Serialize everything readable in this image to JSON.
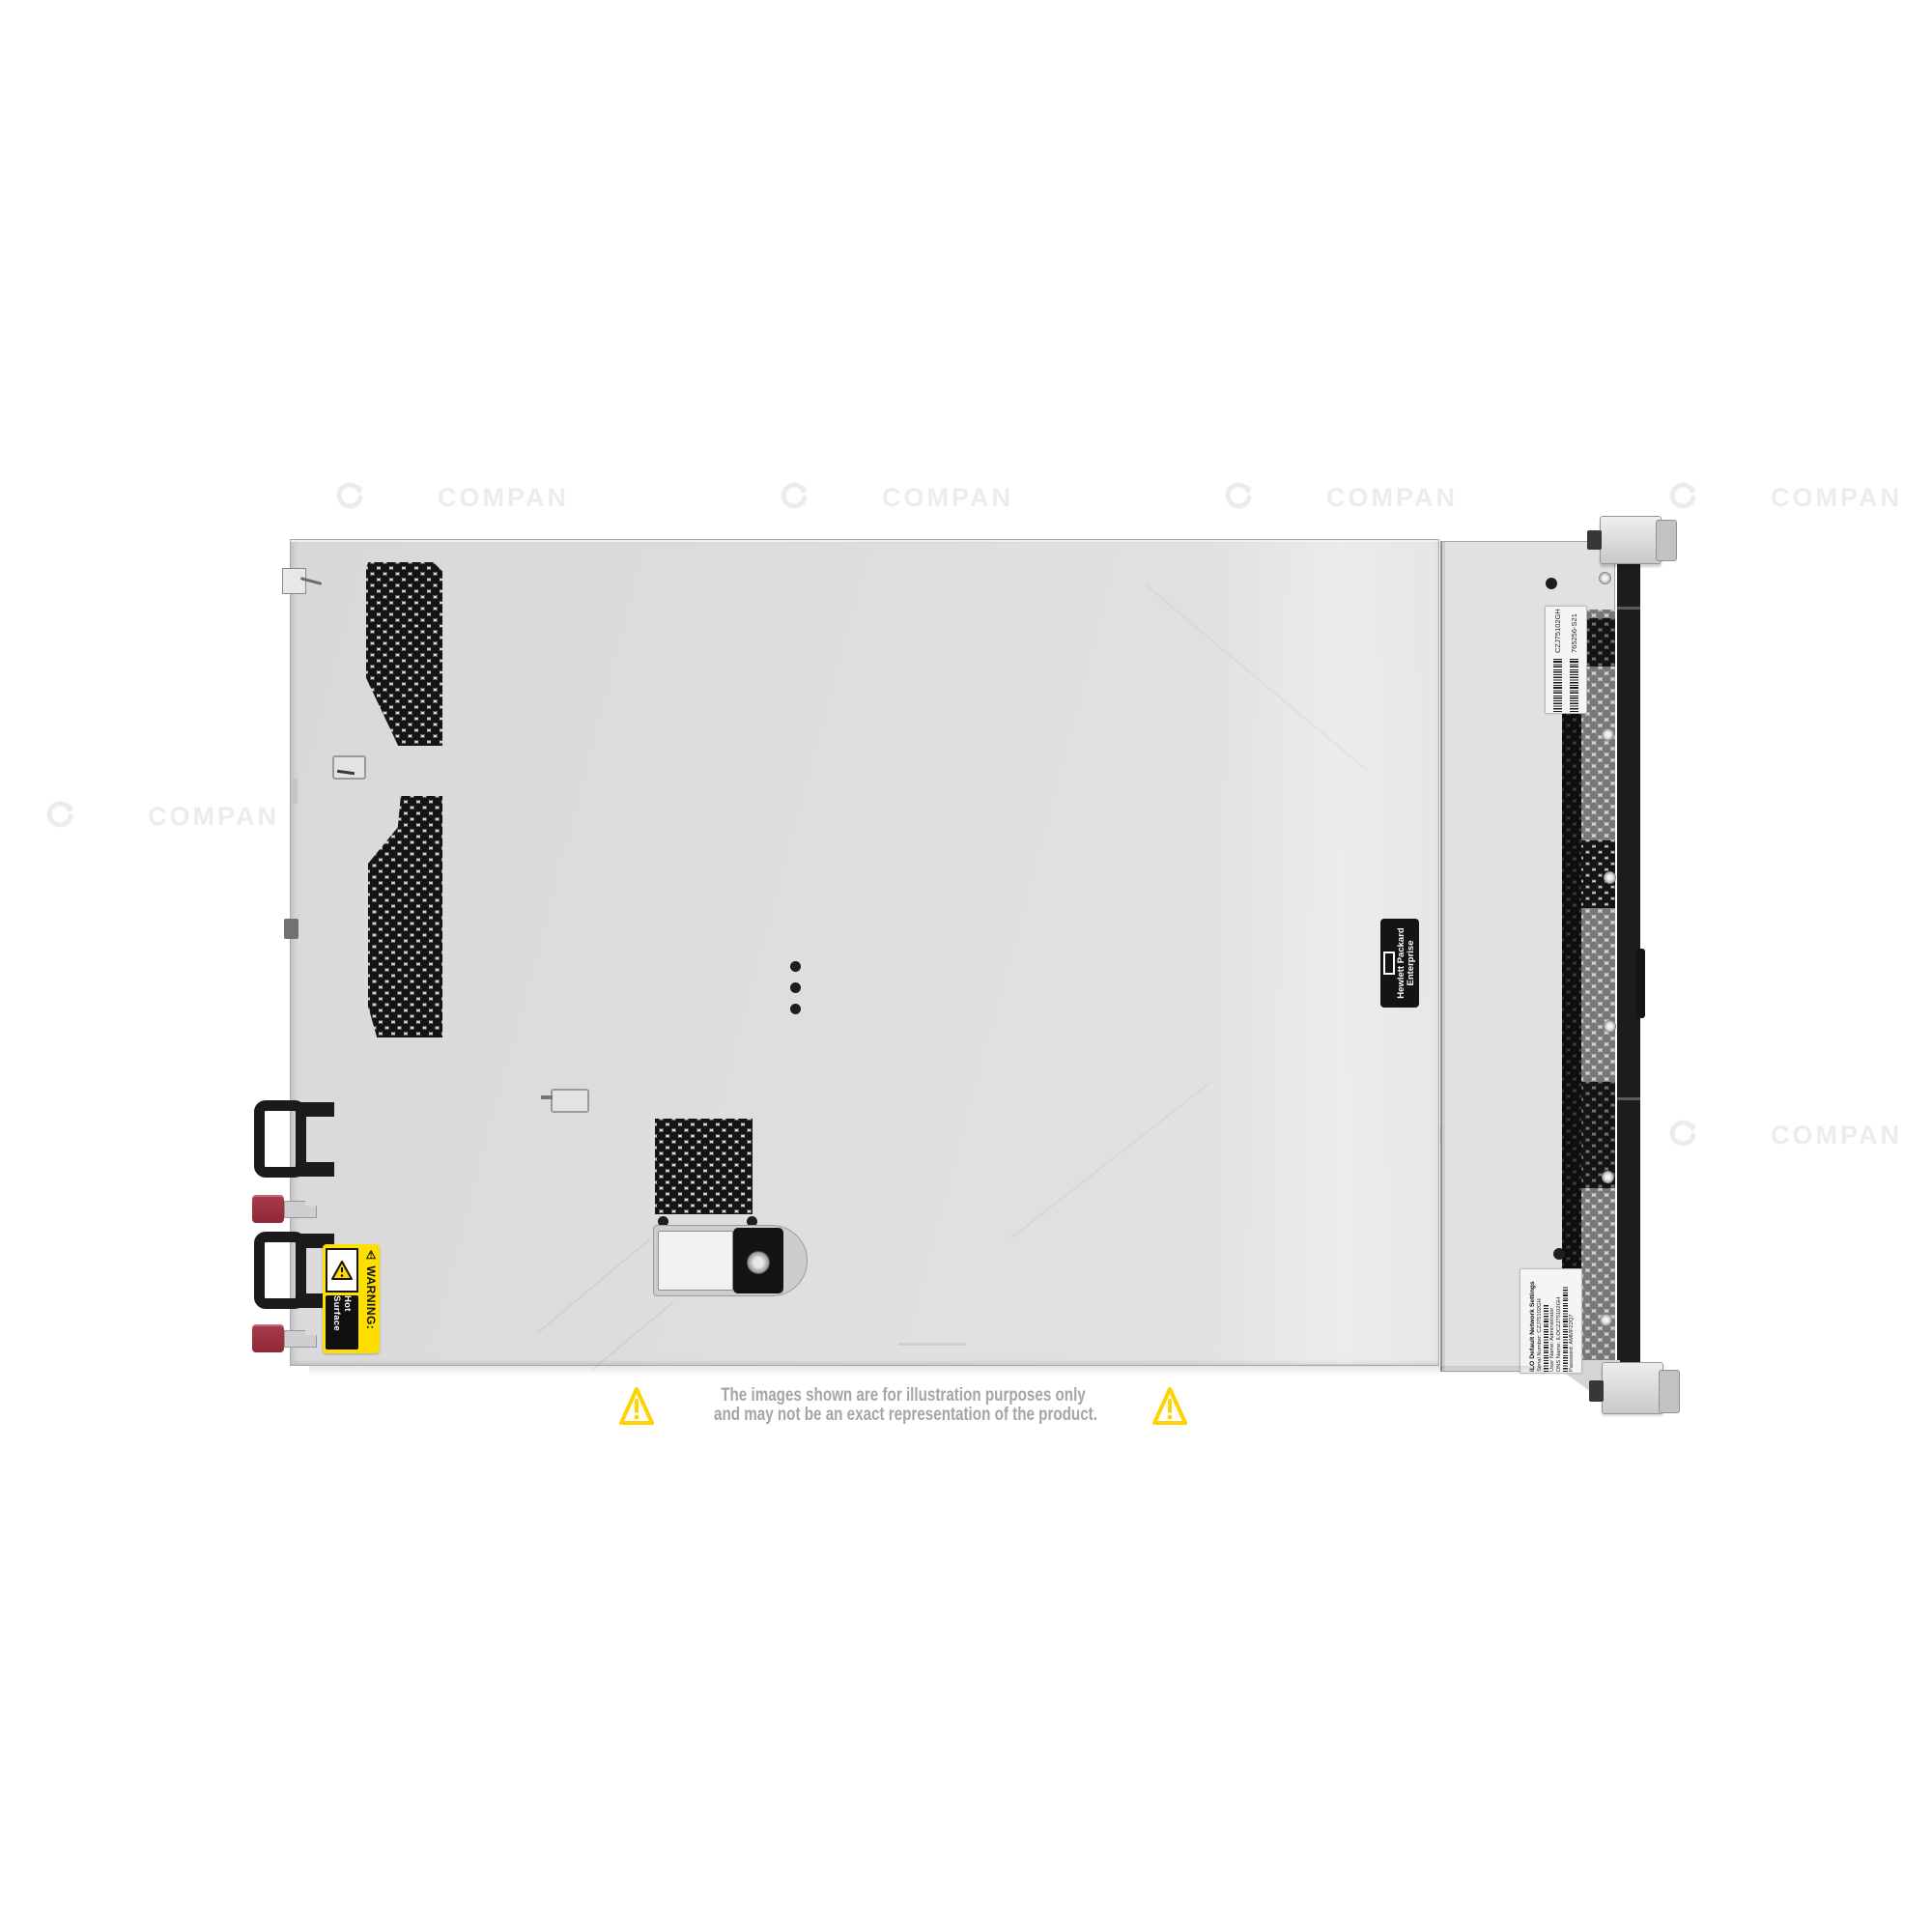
{
  "canvas": {
    "background": "#ffffff"
  },
  "watermark": {
    "text": "COMPAN"
  },
  "server": {
    "labels": {
      "warning": {
        "heading": "⚠ WARNING:",
        "message": "Hot Surface"
      },
      "brand": {
        "line1": "Hewlett Packard",
        "line2": "Enterprise"
      },
      "service_tag": {
        "serial": "CZJ75102GH",
        "part_number": "765256-S21"
      },
      "ilo": {
        "title": "iLO Default Network Settings",
        "serial": "Serial Number: CZJ75102GH",
        "user": "User Name: Administrator",
        "dns": "DNS Name: ILOCZJ75102GH",
        "password": "Password: AMMF22Q7"
      }
    }
  },
  "disclaimer": {
    "line1": "The images shown are for illustration purposes only",
    "line2": "and may not be an exact representation of the product.",
    "triangle_color": "#FFD200",
    "text_color": "#a5a5a5"
  },
  "colors": {
    "chassis": "#dedee0",
    "front_bezel": "#1c1c1e",
    "psu_latch_red": "#9d2e3f",
    "warning_yellow": "#ffdf00"
  }
}
